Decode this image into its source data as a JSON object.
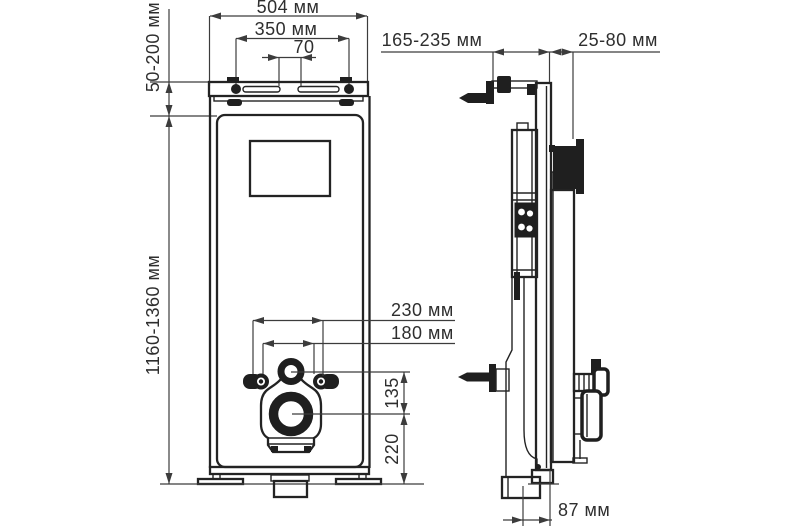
{
  "drawing": {
    "units_note": "мм",
    "front_view": {
      "overall_width": "504 мм",
      "hanger_bolt_spacing": "350 мм",
      "slot_gap": "70",
      "top_rail_offset": "50-200 мм",
      "frame_height": "1160-1360 мм",
      "fixing_outer_spacing": "230 мм",
      "fixing_inner_spacing": "180 мм",
      "fixings_to_outlet": "135",
      "floor_to_outlet": "220"
    },
    "side_view": {
      "wall_bracket_range": "165-235 мм",
      "front_clearance_range": "25-80 мм",
      "outlet_axis_offset": "87 мм"
    },
    "colors": {
      "line": "#232323",
      "dimension": "#3c3c3c",
      "background": "#ffffff"
    }
  }
}
